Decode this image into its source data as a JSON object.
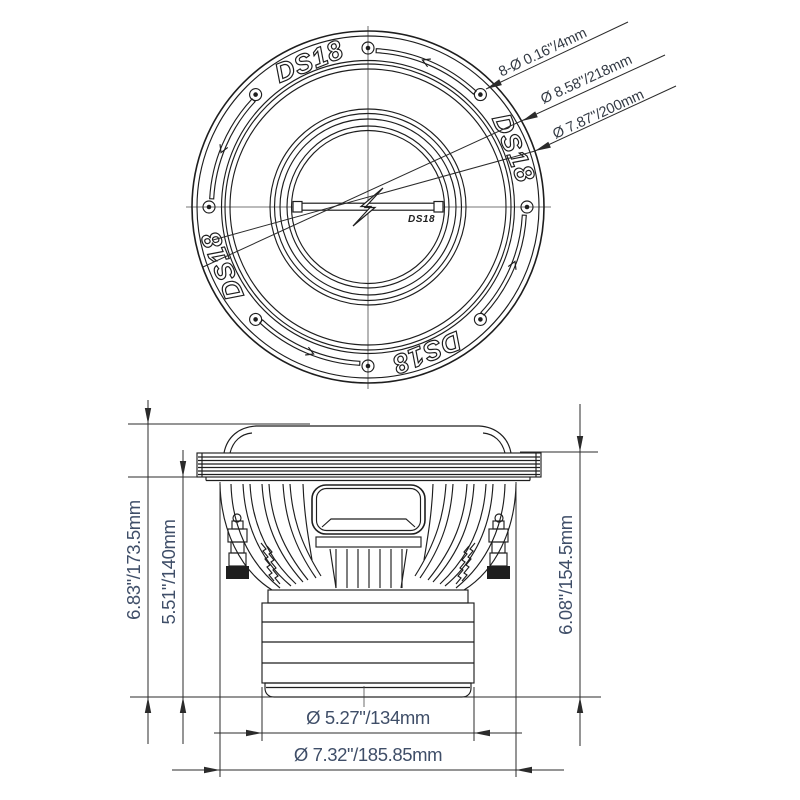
{
  "colors": {
    "line": "#1e1e1e",
    "dim_line": "#2b2b2b",
    "dim_text": "#3f4e68",
    "label_text": "#333a44",
    "background": "#ffffff"
  },
  "brand": "DS18",
  "top_view": {
    "labels": {
      "mounting_holes": "8-Ø 0.16\"/4mm",
      "outer_diameter": "Ø 8.58\"/218mm",
      "bolt_circle_diameter": "Ø 7.87\"/200mm"
    }
  },
  "side_view": {
    "labels": {
      "total_height": "6.83\"/173.5mm",
      "mounting_depth": "5.51\"/140mm",
      "depth_below_flange": "6.08\"/154.5mm",
      "magnet_diameter": "Ø 5.27\"/134mm",
      "basket_diameter": "Ø 7.32\"/185.85mm"
    }
  }
}
